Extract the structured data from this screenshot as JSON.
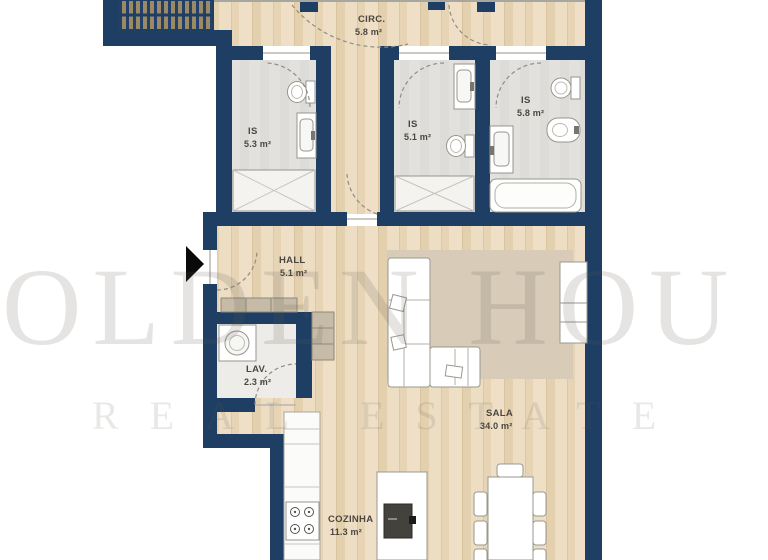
{
  "title": "apartment-floor-plan",
  "watermark": {
    "line1": "OLDEN HOU",
    "line2": "REAL ESTATE"
  },
  "rooms": {
    "circ": {
      "name": "CIRC.",
      "area": "5.8 m²"
    },
    "is_a": {
      "name": "IS",
      "area": "5.3 m²"
    },
    "is_b": {
      "name": "IS",
      "area": "5.1 m²"
    },
    "is_c": {
      "name": "IS",
      "area": "5.8 m²"
    },
    "hall": {
      "name": "HALL",
      "area": "5.1 m²"
    },
    "lav": {
      "name": "LAV.",
      "area": "2.3 m²"
    },
    "sala": {
      "name": "SALA",
      "area": "34.0 m²"
    },
    "cozinha": {
      "name": "COZINHA",
      "area": "11.3 m²"
    }
  },
  "fixtures": [
    "staircase",
    "toilet",
    "bidet",
    "washbasin-vanity",
    "shower",
    "bathtub",
    "washing-machine",
    "wardrobe",
    "cabinet",
    "kitchen-counter",
    "stove-hob",
    "kitchen-island",
    "island-sink",
    "dining-table",
    "dining-chairs",
    "sofa",
    "rug",
    "sideboard",
    "entrance-arrow"
  ],
  "colors": {
    "wall": "#1e3e63",
    "wood_floor": "#e9d8bb",
    "bath_floor": "#e1e0dd",
    "lav_floor": "#edece8",
    "rug": "#d8cbb7",
    "cabinet": "#c5bba6",
    "watermark": "#d9d9d9",
    "label_text": "#4b4740"
  }
}
